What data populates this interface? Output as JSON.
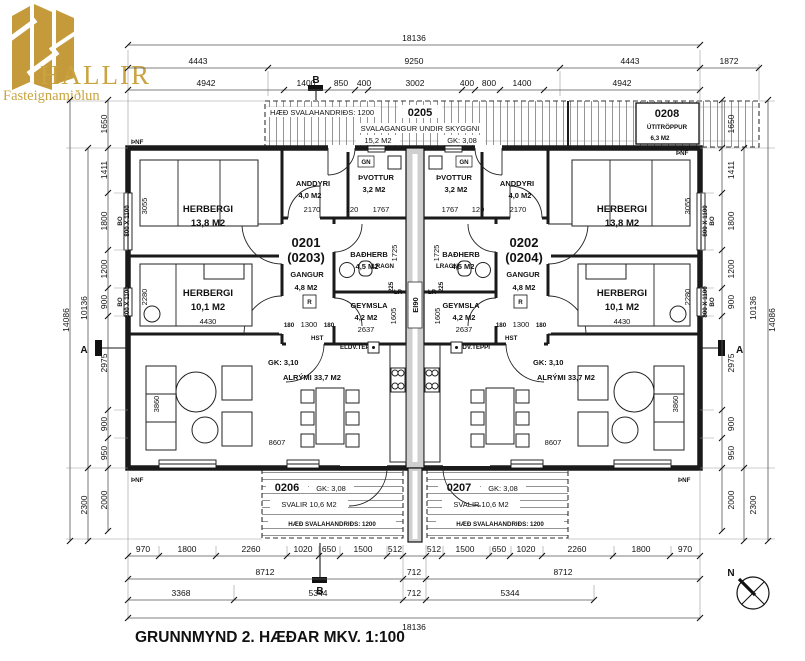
{
  "logo": {
    "name": "HALLIR",
    "tagline": "Fasteignamiðlun"
  },
  "title": "GRUNNMYND 2. HÆÐAR  MKV. 1:100",
  "compass": {
    "north": "N"
  },
  "units": {
    "left": {
      "number": "0201",
      "alt": "(0203)"
    },
    "right": {
      "number": "0202",
      "alt": "(0204)"
    }
  },
  "rooms": {
    "herbergi_large": {
      "name": "HERBERGI",
      "area": "13,8 M2"
    },
    "herbergi_small": {
      "name": "HERBERGI",
      "area": "10,1 M2"
    },
    "anddyri": {
      "name": "ANDDYRI",
      "area": "4,0 M2"
    },
    "thvottur": {
      "name": "ÞVOTTUR",
      "area": "3,2 M2"
    },
    "gangur": {
      "name": "GANGUR",
      "area": "4,8 M2"
    },
    "badherb": {
      "name": "BAÐHERB",
      "area": "4,5 M2"
    },
    "geymsla": {
      "name": "GEYMSLA",
      "area": "4,2 M2"
    },
    "alrymi": {
      "gk": "GK: 3,10",
      "label": "ALRÝMI 33,7 M2"
    }
  },
  "balconies": {
    "svalagangur": {
      "number": "0205",
      "railing": "HÆÐ SVALAHANDRIÐS: 1200",
      "name": "SVALAGANGUR UNDIR SKYGGNI",
      "area": "15,2 M2",
      "gk": "GK: 3,08"
    },
    "utitroppur": {
      "number": "0208",
      "name": "ÚTITRÖPPUR",
      "area": "6,3 M2"
    },
    "svalir_left": {
      "number": "0206"
    },
    "svalir_right": {
      "number": "0207"
    },
    "svalir": {
      "gk": "GK: 3,08",
      "label": "SVALIR 10,6 M2",
      "railing": "HÆÐ SVALAHANDRIÐS: 1200"
    }
  },
  "markers": {
    "pnf": "ÞNF",
    "a": "A",
    "b": "B",
    "ei90": "EI90",
    "lr": "LR",
    "lragn": "LRAGN",
    "gn": "GN",
    "r": "R",
    "hst": "HST",
    "eldv": "ELDV.TEPPI",
    "bo": "BO",
    "bo_size": "800 X 1100"
  },
  "dims": {
    "top": {
      "total": "18136",
      "row2": [
        "4443",
        "9250",
        "4443",
        "1872"
      ],
      "row3": [
        "4942",
        "1400",
        "850",
        "400",
        "3002",
        "400",
        "800",
        "1400",
        "4942"
      ]
    },
    "bottom": {
      "row1": [
        "970",
        "1800",
        "2260",
        "1020",
        "650",
        "1500",
        "512",
        "512",
        "1500",
        "650",
        "1020",
        "2260",
        "1800",
        "970"
      ],
      "row2": [
        "8712",
        "712",
        "8712"
      ],
      "row3": [
        "3368",
        "5344",
        "712",
        "5344"
      ],
      "total": "18136"
    },
    "side": {
      "stair": "1650",
      "col": [
        "1411",
        "1800",
        "1200",
        "900",
        "2975",
        "900",
        "950"
      ],
      "below": [
        "2000",
        "2300"
      ],
      "sub": "10136",
      "total": "14086"
    },
    "interior": {
      "d3055": "3055",
      "d2280": "2280",
      "d4430": "4430",
      "d2170": "2170",
      "d120": "120",
      "d1767": "1767",
      "d1725": "1725",
      "d1605": "1605",
      "d225": "225",
      "d2637": "2637",
      "d180": "180",
      "d1300": "1300",
      "d8607": "8607",
      "d3860": "3860"
    }
  }
}
